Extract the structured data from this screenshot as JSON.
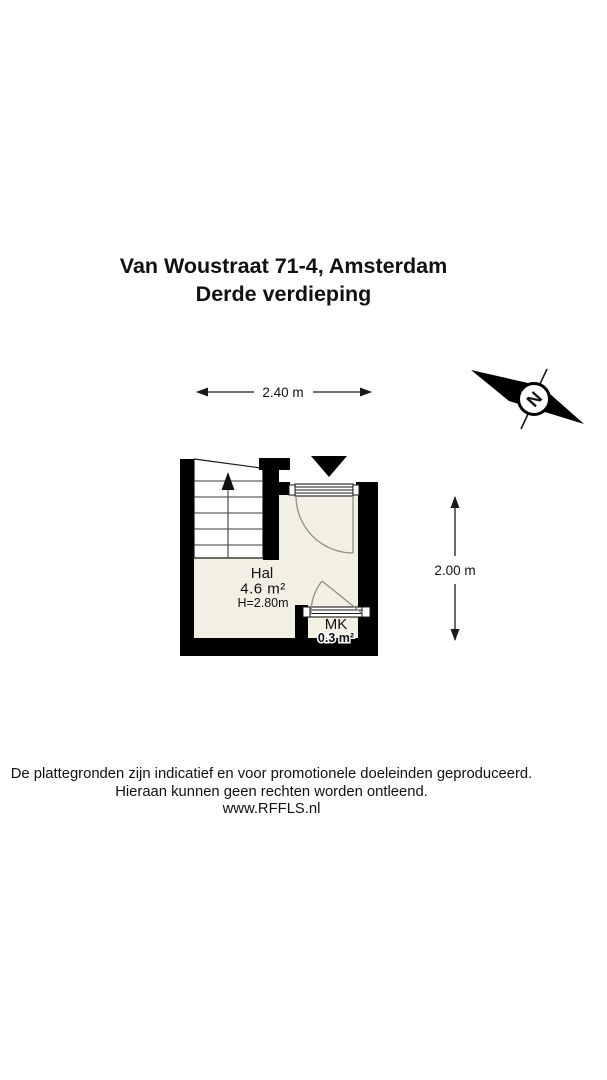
{
  "title": {
    "line1": "Van Woustraat 71-4, Amsterdam",
    "line2": "Derde verdieping"
  },
  "dimensions": {
    "width_label": "2.40 m",
    "height_label": "2.00 m"
  },
  "rooms": {
    "hal": {
      "name": "Hal",
      "area": "4.6 m²",
      "ceiling_height": "H=2.80m"
    },
    "mk": {
      "name": "MK",
      "area": "0.3 m²"
    }
  },
  "compass": {
    "label": "N"
  },
  "footer": {
    "line1": "De plattegronden zijn indicatief en voor promotionele doeleinden geproduceerd.",
    "line2": "Hieraan kunnen geen rechten worden ontleend.",
    "line3": "www.RFFLS.nl"
  },
  "colors": {
    "wall": "#000000",
    "floor": "#f2efe3",
    "background": "#ffffff"
  }
}
